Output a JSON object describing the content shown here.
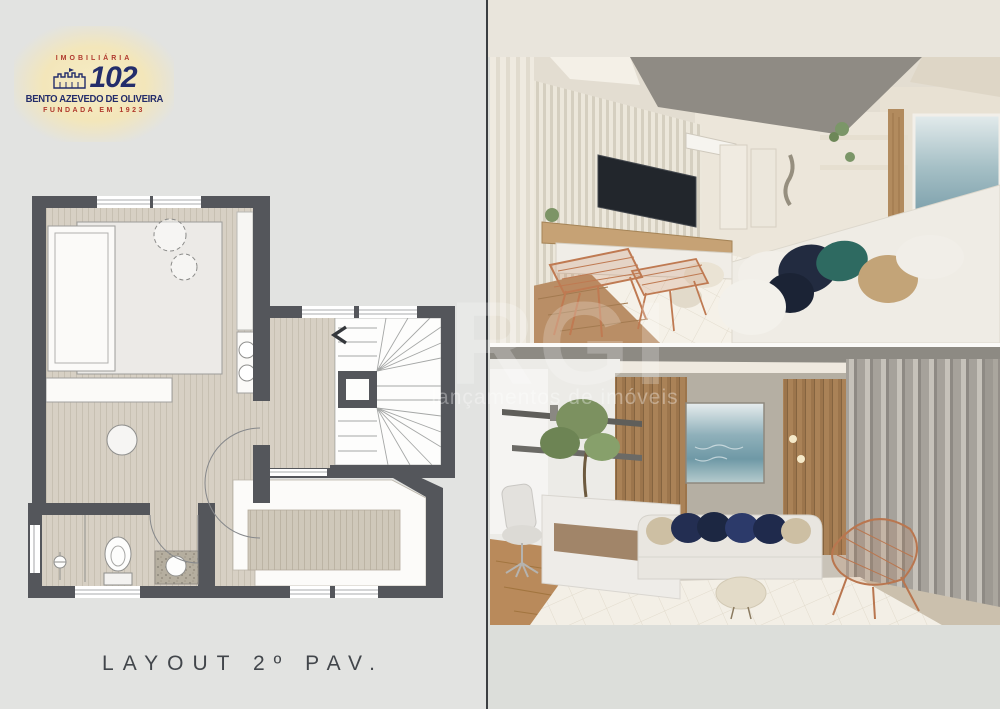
{
  "logo": {
    "imobiliaria": "IMOBILIÁRIA",
    "number": "102",
    "name": "BENTO AZEVEDO DE OLIVEIRA",
    "founded": "FUNDADA EM 1923",
    "navy": "#232d6b",
    "red": "#b0392d",
    "glow": "#f3e6ba"
  },
  "floor_plan": {
    "caption": "LAYOUT 2º PAV.",
    "wall_color": "#54565b",
    "floor_color": "#d7d0c4",
    "caption_color": "#42464b"
  },
  "watermark": {
    "big": "RGI",
    "small": "lançamentos de imóveis"
  },
  "panel_colors": {
    "left_background": "#e2e3e1",
    "right_top_band": "#e9e5dc",
    "right_bottom": "#dcdeda",
    "divider": "#3b3e41",
    "photo_gap": "#fbfaf8"
  }
}
